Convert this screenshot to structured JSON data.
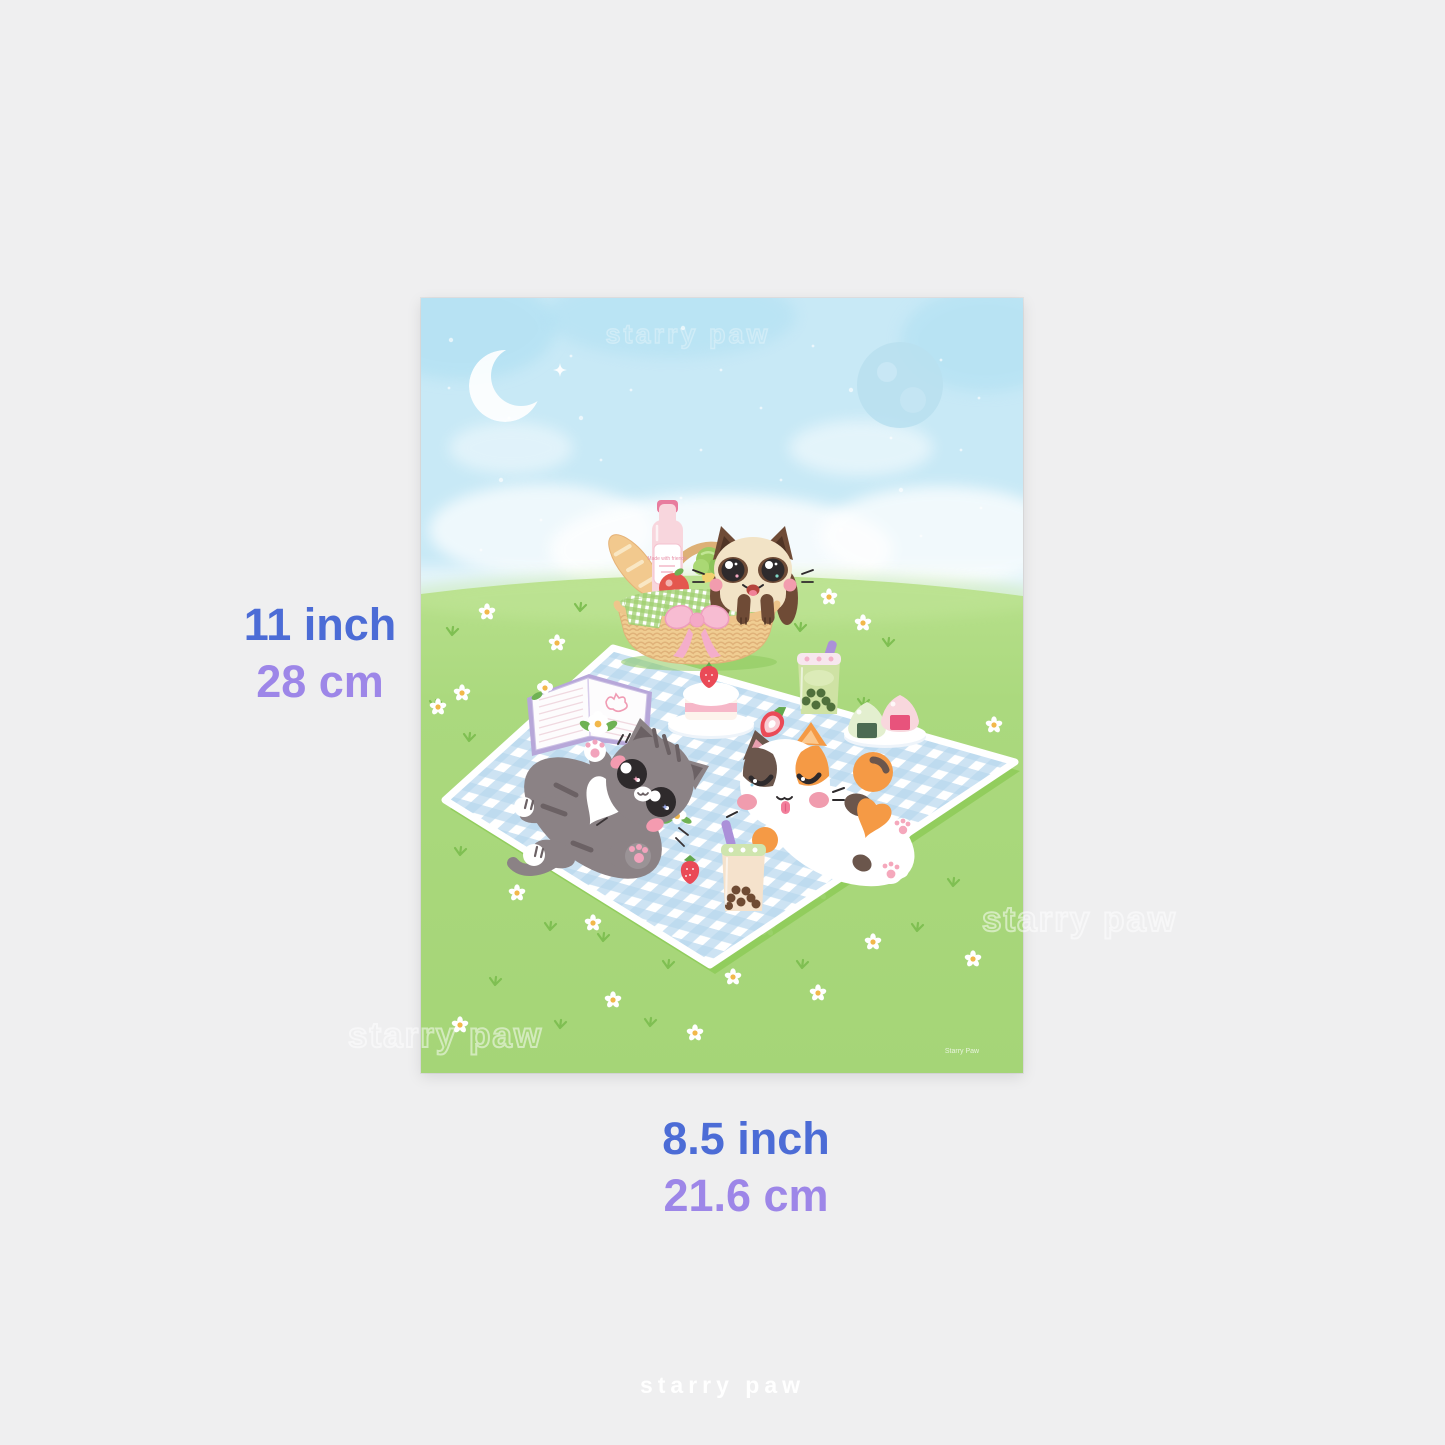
{
  "page": {
    "background_color": "#efeff0"
  },
  "dimension_labels": {
    "height": {
      "line1": "11 inch",
      "line2": "28 cm"
    },
    "width": {
      "line1": "8.5 inch",
      "line2": "21.6 cm"
    },
    "inch_color": "#4c6cd6",
    "cm_color": "#9d86e8"
  },
  "watermarks": {
    "brand": "starry paw",
    "signature": "Starry Paw",
    "footer": "starry paw"
  },
  "poster": {
    "bottle_label": "Made with friends"
  },
  "artwork": {
    "palette": {
      "sky": "#c8e9f6",
      "grass": "#a9d87c",
      "grass_accent": "#7fbf52",
      "blanket_blue": "#b8d7ef",
      "basket_tan": "#f0cd92",
      "bow_pink": "#f7bcd2",
      "gray_cat": "#8b8285",
      "calico_orange": "#f59a45",
      "calico_brown": "#6b564c",
      "siamese_cream": "#f2e3c6",
      "siamese_brown": "#6f4b36",
      "strawberry_red": "#ea4a57",
      "blush_pink": "#f49bb0",
      "straw_purple": "#ab90d9"
    },
    "flowers": [
      [
        66,
        314
      ],
      [
        136,
        345
      ],
      [
        408,
        299
      ],
      [
        351,
        300
      ],
      [
        442,
        325
      ],
      [
        41,
        395
      ],
      [
        17,
        409
      ],
      [
        409,
        370
      ],
      [
        481,
        410
      ],
      [
        573,
        427
      ],
      [
        497,
        520
      ],
      [
        96,
        595
      ],
      [
        399,
        594
      ],
      [
        172,
        625
      ],
      [
        346,
        630
      ],
      [
        452,
        644
      ],
      [
        312,
        679
      ],
      [
        397,
        695
      ],
      [
        192,
        702
      ],
      [
        39,
        727
      ],
      [
        274,
        735
      ],
      [
        552,
        661
      ]
    ],
    "grass_tufts": [
      [
        159,
        310
      ],
      [
        31,
        334
      ],
      [
        379,
        330
      ],
      [
        467,
        345
      ],
      [
        14,
        407
      ],
      [
        442,
        405
      ],
      [
        39,
        554
      ],
      [
        457,
        555
      ],
      [
        369,
        609
      ],
      [
        129,
        629
      ],
      [
        182,
        640
      ],
      [
        496,
        630
      ],
      [
        247,
        667
      ],
      [
        381,
        667
      ],
      [
        74,
        684
      ],
      [
        139,
        727
      ],
      [
        229,
        725
      ],
      [
        532,
        585
      ],
      [
        48,
        440
      ],
      [
        550,
        480
      ]
    ],
    "sky_speckles": [
      [
        30,
        42
      ],
      [
        88,
        120
      ],
      [
        150,
        58
      ],
      [
        210,
        92
      ],
      [
        262,
        30
      ],
      [
        300,
        72
      ],
      [
        340,
        110
      ],
      [
        392,
        48
      ],
      [
        430,
        92
      ],
      [
        470,
        140
      ],
      [
        520,
        62
      ],
      [
        558,
        100
      ],
      [
        80,
        182
      ],
      [
        180,
        162
      ],
      [
        280,
        152
      ],
      [
        360,
        182
      ],
      [
        480,
        192
      ],
      [
        540,
        152
      ],
      [
        120,
        222
      ],
      [
        240,
        212
      ],
      [
        420,
        232
      ],
      [
        60,
        252
      ],
      [
        500,
        238
      ],
      [
        330,
        248
      ],
      [
        160,
        120
      ],
      [
        560,
        210
      ],
      [
        260,
        200
      ],
      [
        28,
        90
      ]
    ]
  }
}
